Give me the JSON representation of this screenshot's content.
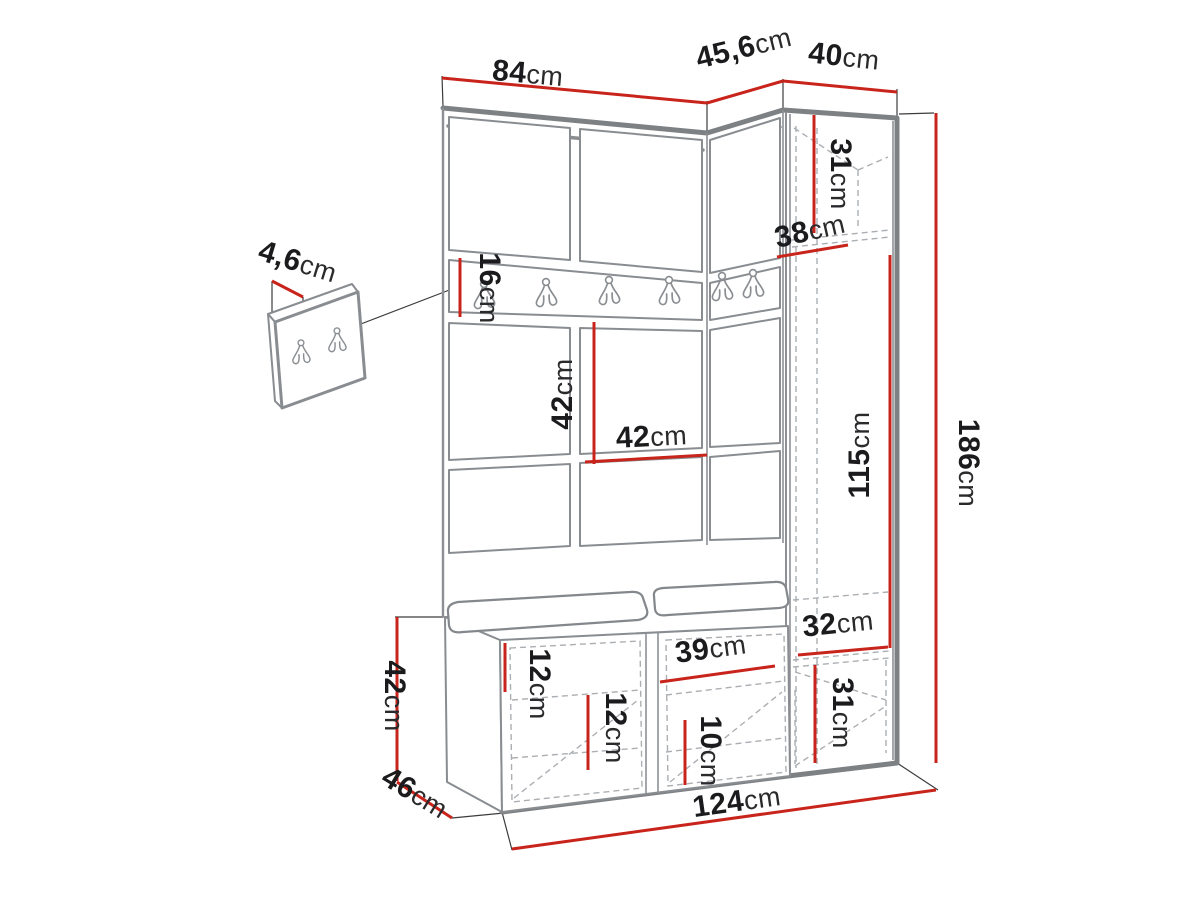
{
  "figure": {
    "type": "furniture-dimension-diagram",
    "subject": "hallway wardrobe set with hook rail, open column, bench and shoe cabinet plus small wall hook panel",
    "unit": "cm",
    "accent_color": "#c8241b",
    "outline_color": "#7e8184",
    "dashed_color": "#abafb3",
    "text_color": "#1b1b1d",
    "background_color": "#ffffff"
  },
  "dimensions": {
    "top_width_left": {
      "value": "84",
      "unit": "cm"
    },
    "top_width_corner": {
      "value": "45,6",
      "unit": "cm"
    },
    "top_width_right": {
      "value": "40",
      "unit": "cm"
    },
    "right_top_compartment": {
      "value": "31",
      "unit": "cm"
    },
    "corner_shelf_width": {
      "value": "38",
      "unit": "cm"
    },
    "total_height": {
      "value": "186",
      "unit": "cm"
    },
    "open_column_height": {
      "value": "115",
      "unit": "cm"
    },
    "hook_rail_height": {
      "value": "16",
      "unit": "cm"
    },
    "wall_panel_height": {
      "value": "42",
      "unit": "cm"
    },
    "wall_panel_width": {
      "value": "42",
      "unit": "cm"
    },
    "mini_panel_depth": {
      "value": "4,6",
      "unit": "cm"
    },
    "bench_side_height": {
      "value": "42",
      "unit": "cm"
    },
    "bench_depth": {
      "value": "46",
      "unit": "cm"
    },
    "bench_top_clearance": {
      "value": "12",
      "unit": "cm"
    },
    "bench_shelf_gap": {
      "value": "12",
      "unit": "cm"
    },
    "shoe_compartment_width": {
      "value": "39",
      "unit": "cm"
    },
    "shoe_shelf_gap": {
      "value": "10",
      "unit": "cm"
    },
    "right_bottom_shelf": {
      "value": "32",
      "unit": "cm"
    },
    "right_bottom_compartment": {
      "value": "31",
      "unit": "cm"
    },
    "total_width": {
      "value": "124",
      "unit": "cm"
    }
  }
}
